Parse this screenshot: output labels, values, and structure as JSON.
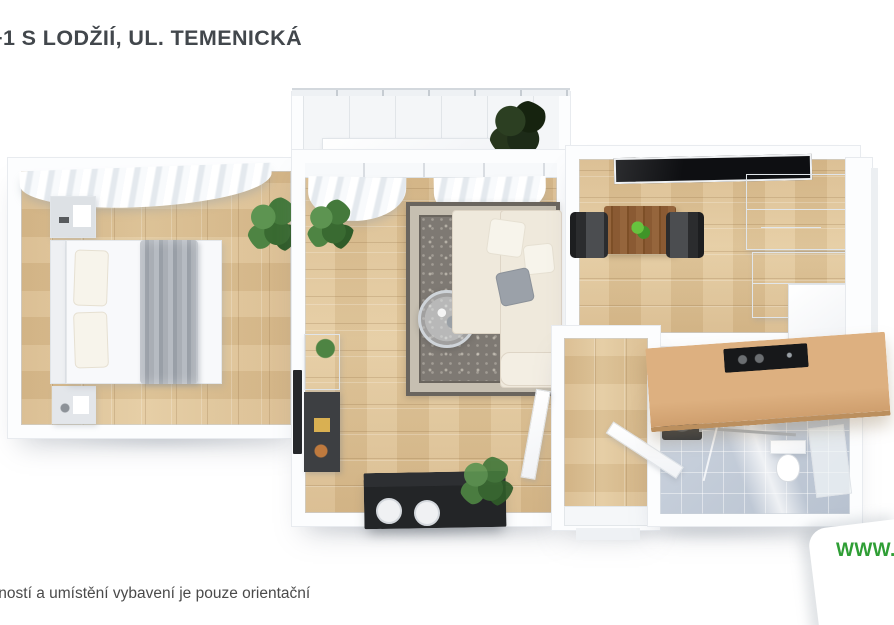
{
  "title": "+1 S LODŽIÍ, UL. TEMENICKÁ",
  "disclaimer": "tností a umístění vybavení je pouze orientační",
  "watermark": {
    "www": "WWW.",
    "partial": "N"
  },
  "colors": {
    "title_text": "#42474c",
    "disclaimer_text": "#4a4a4a",
    "watermark_green": "#2f9e35",
    "background": "#ffffff",
    "wall_white": "#fcfdfe",
    "wood_floor": "#dcc094",
    "rug_gray": "#7e7973",
    "rug_border": "#c6bfb1",
    "sofa_cream": "#efe9dc",
    "bathroom_tile": "#c6cfdb",
    "island_wood": "#d8a976",
    "appliance_black": "#17181a",
    "dining_table_wood": "#8a5a33",
    "plant_green": "#4e8447",
    "blanket_gray": "#9aa0a8"
  }
}
